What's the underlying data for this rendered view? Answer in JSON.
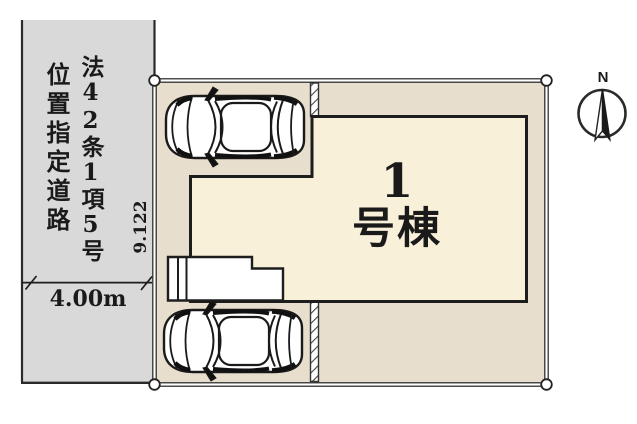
{
  "diagram": {
    "road": {
      "label_column_right": "法42条1項5号",
      "label_column_left": "位置指定道路",
      "width_label": "4.00m"
    },
    "site": {
      "boundary_dimension": "9.122"
    },
    "building": {
      "number": "1",
      "suffix": "号棟"
    },
    "compass": {
      "north": "N"
    },
    "colors": {
      "road_fill": "#d9d9d9",
      "site_fill": "#e8decd",
      "building_fill": "#f8f0d9",
      "line": "#1d1d1d"
    }
  }
}
